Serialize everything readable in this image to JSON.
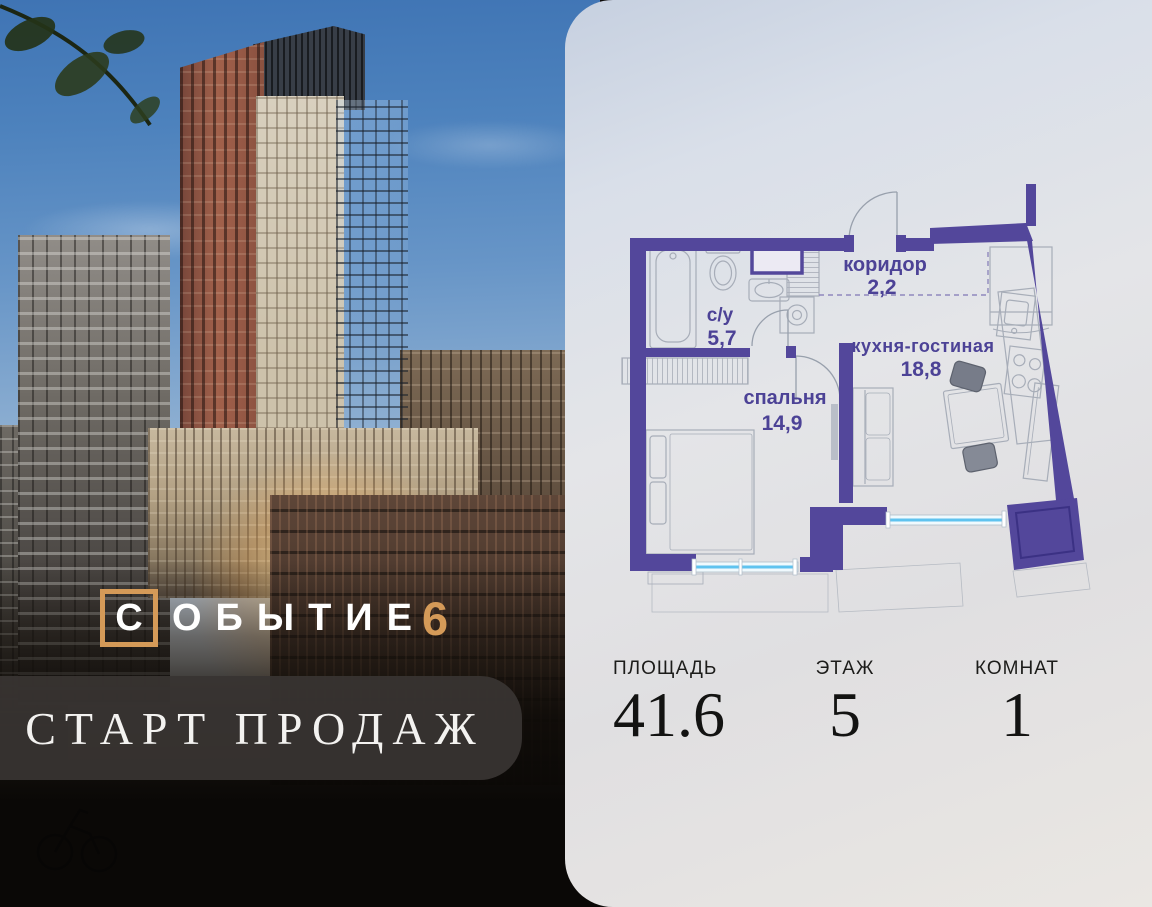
{
  "brand": {
    "boxed_letter": "С",
    "wordmark": "ОБЫТИЕ",
    "number": "6",
    "banner": "СТАРТ ПРОДАЖ",
    "accent_color": "#D49A58"
  },
  "plan": {
    "wall_color": "#53479B",
    "window_color": "#5FC3EF",
    "label_color": "#4C4296",
    "rooms": [
      {
        "name": "с/у",
        "area": "5,7"
      },
      {
        "name": "коридор",
        "area": "2,2"
      },
      {
        "name": "кухня-гостиная",
        "area": "18,8"
      },
      {
        "name": "спальня",
        "area": "14,9"
      }
    ]
  },
  "stats": [
    {
      "label": "ПЛОЩАДЬ",
      "value": "41.6"
    },
    {
      "label": "ЭТАЖ",
      "value": "5"
    },
    {
      "label": "КОМНАТ",
      "value": "1"
    }
  ]
}
